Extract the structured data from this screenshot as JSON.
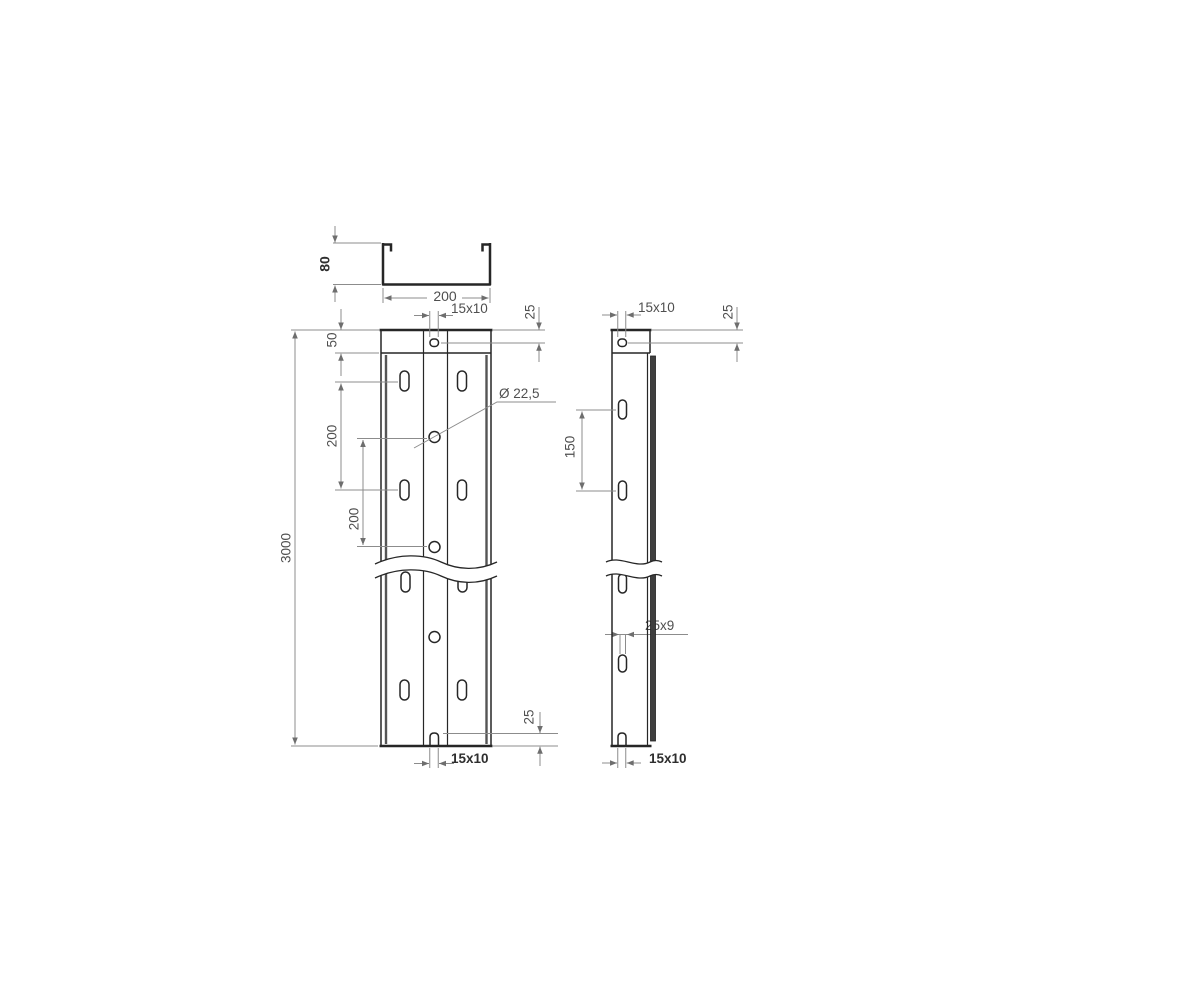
{
  "drawing": {
    "title": "channel-profile-dimension-drawing",
    "colors": {
      "part_line": "#262626",
      "dimension_line": "#8c8c8c",
      "text": "#4f4f4f",
      "background": "#ffffff"
    },
    "labels": {
      "cross_section": {
        "height": "80",
        "width": "200"
      },
      "front_view": {
        "top_slot": "15x10",
        "top_offset": "25",
        "end_band": "50",
        "slot_pitch": "200",
        "hole_pitch": "200",
        "length": "3000",
        "hole_dia": "Ø 22,5",
        "bottom_offset": "25",
        "bottom_slot": "15x10"
      },
      "side_view": {
        "top_slot": "15x10",
        "top_offset": "25",
        "slot_pitch": "150",
        "side_slot": "25x9",
        "bottom_slot": "15x10"
      }
    }
  }
}
